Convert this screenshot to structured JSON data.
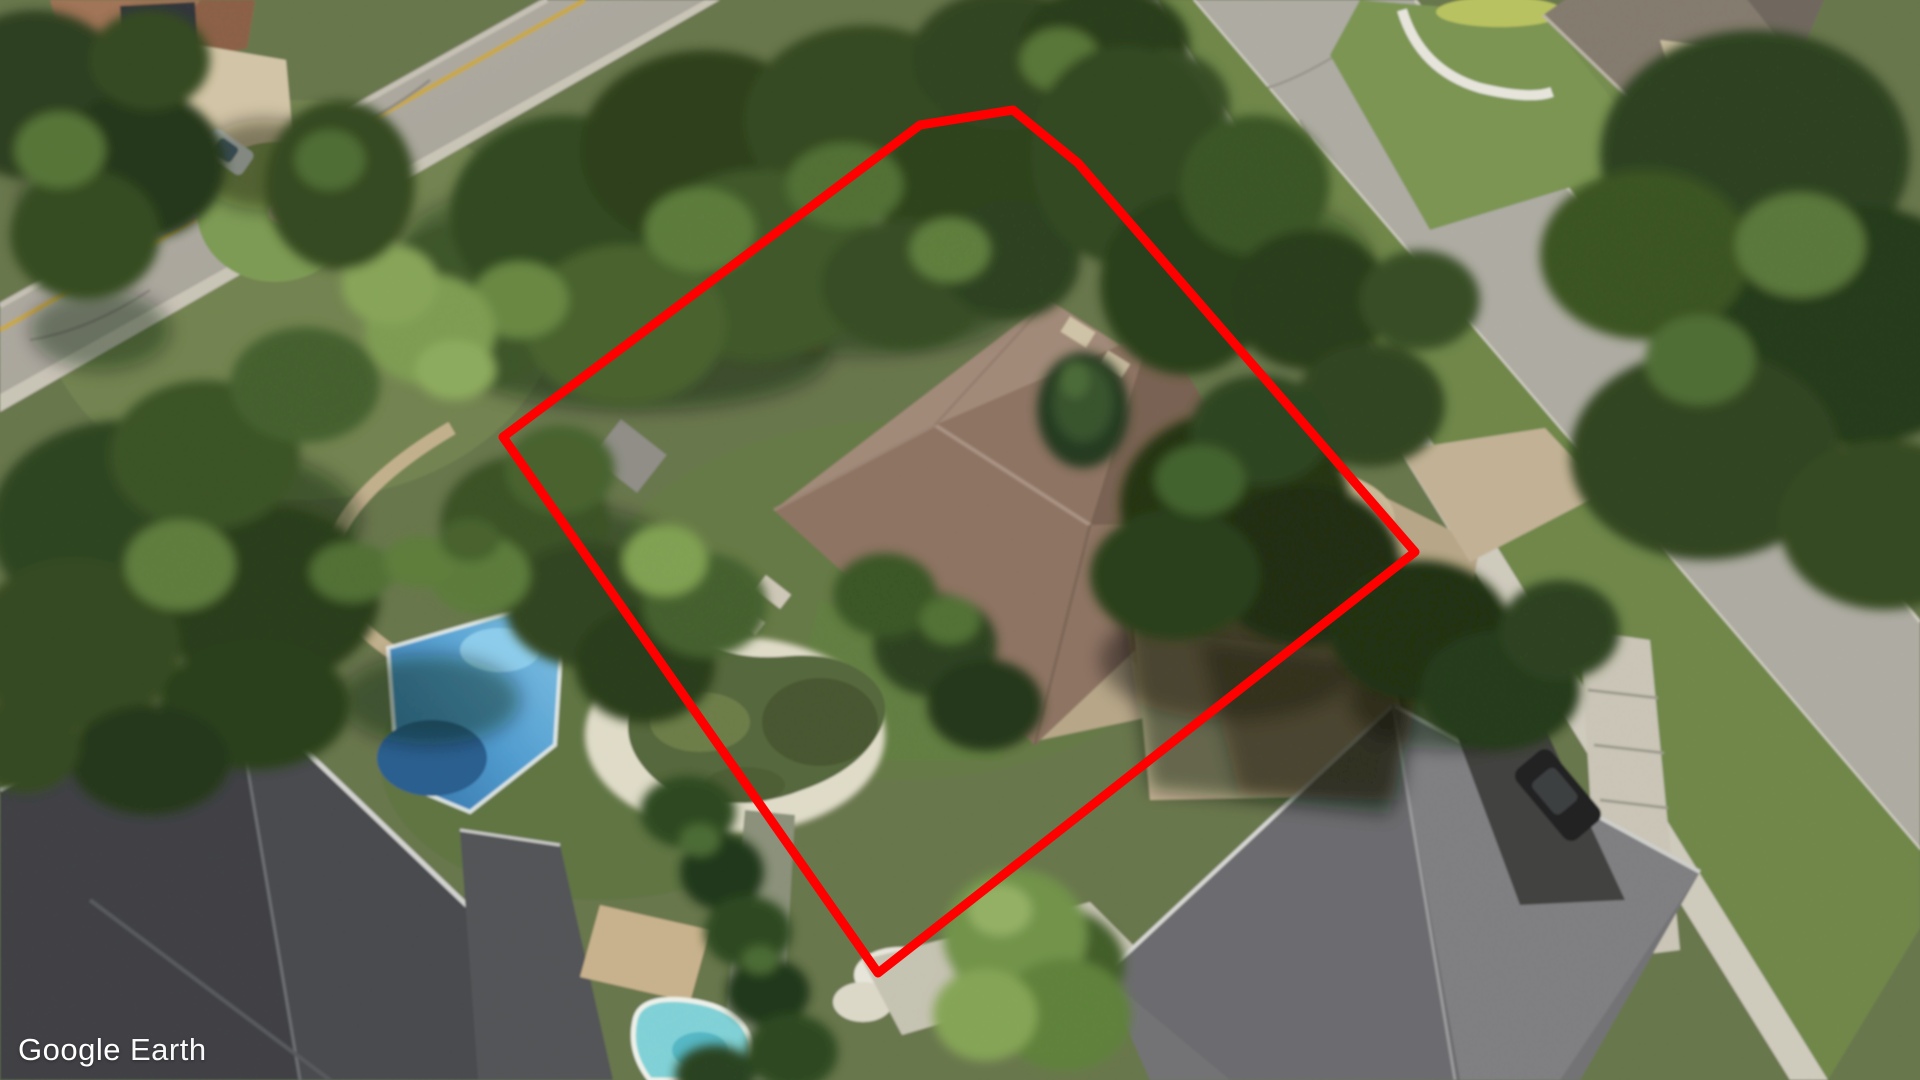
{
  "map_canvas": {
    "type": "satellite-aerial-imagery",
    "watermark": {
      "brand": "Google",
      "product": "Earth",
      "color": "#ffffff"
    },
    "parcel_outline": {
      "color": "#ff0000",
      "stroke_width": 9,
      "points": "503,437 920,125 1013,110 1078,163 1415,552 878,973"
    },
    "scene_palette": {
      "tree_dark": "#223616",
      "tree_mid": "#33491f",
      "tree_light": "#6f9246",
      "grass": "#6a7848",
      "road_pavement": "#a9a59b",
      "road_centerline_yellow": "#c8a84b",
      "dirt_yard": "#b7a687",
      "subject_roof_brown": "#8d7261",
      "neighbor_roof_gray": "#717174",
      "neighbor_roof_charcoal": "#46484c",
      "pool_blue": "#5fa8d6",
      "pool_cyan": "#7fd2d8",
      "pond_green": "#54663a",
      "sand_rim": "#e3dfcc"
    }
  }
}
